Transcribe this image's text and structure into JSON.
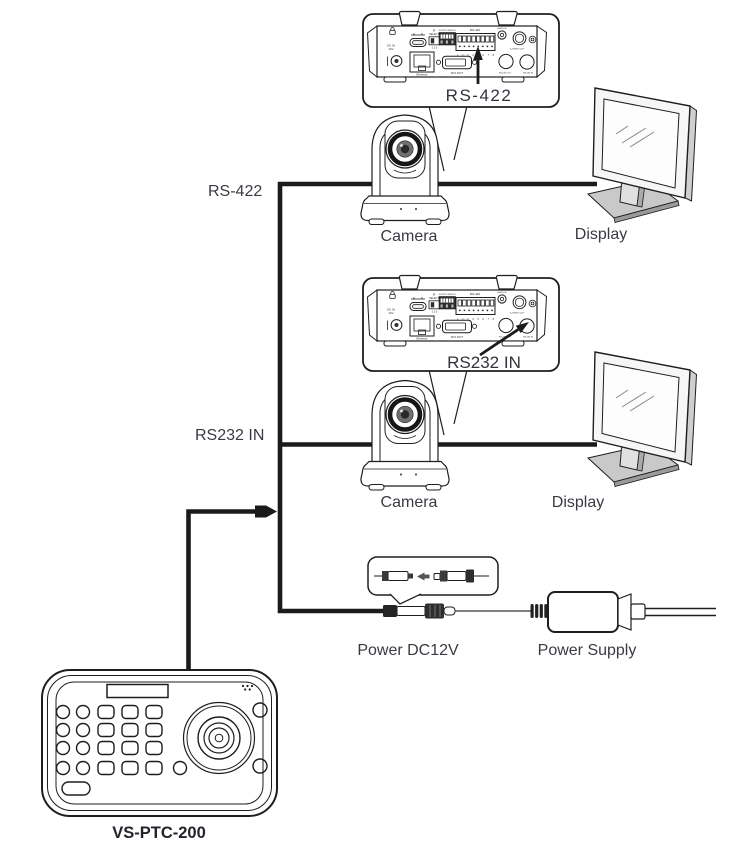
{
  "diagram_type": "connection-diagram",
  "labels": {
    "callout_rs422": "RS-422",
    "callout_rs232": "RS232 IN",
    "rs422_bus": "RS-422",
    "rs232_bus": "RS232 IN",
    "camera_1": "Camera",
    "camera_2": "Camera",
    "display_1": "Display",
    "display_2": "Display",
    "power_dc": "Power DC12V",
    "power_supply": "Power Supply",
    "controller_model": "VS-PTC-200"
  },
  "rear_panel": {
    "dc_in_line1": "DC IN",
    "dc_in_line2": "12V",
    "ethernet": "Ethernet",
    "ir_line1": "IR",
    "ir_line2": "SELECT",
    "ir_positions": "1 2 3",
    "output_switch": "OUTPUT SWITCH",
    "rs422": "RS-422",
    "rs422_pins": "1 2 3 4 5 6 7 8",
    "dvi": "DVI OUT",
    "audio_in": "AUDIO IN",
    "s_video": "S-VIDEO OUT",
    "rs232_out": "RS-232 OUT",
    "rs232_in": "RS-232 IN"
  },
  "colors": {
    "line_ink": "#1b1b1d",
    "label_text": "#3a3a44",
    "monitor_gray": "#c9c9c9",
    "monitor_dark_gray": "#9a9a9a",
    "connector_dark": "#2e2e2e",
    "background": "#ffffff"
  }
}
